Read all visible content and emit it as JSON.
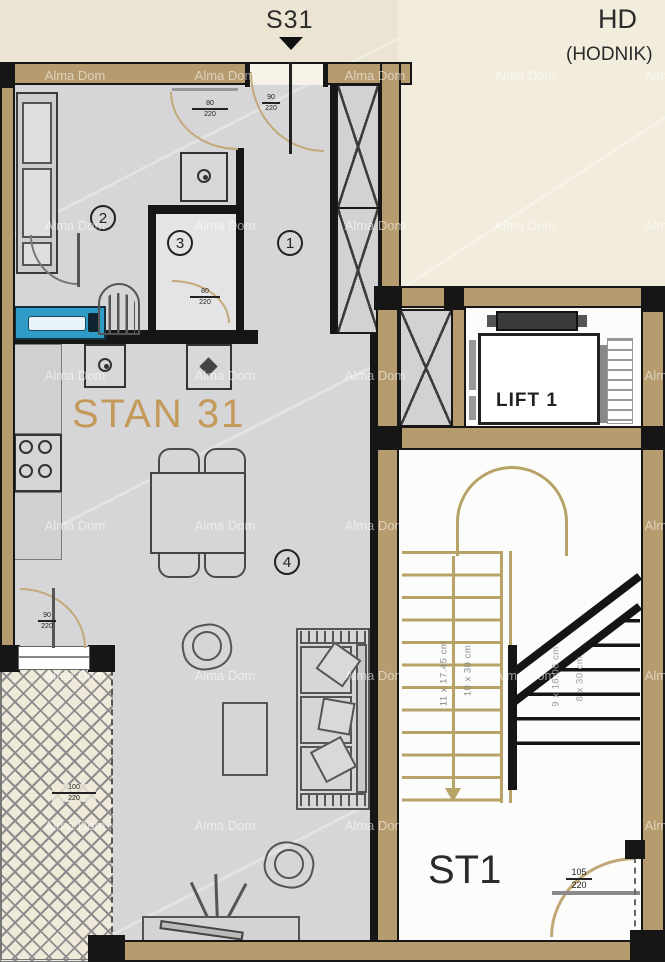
{
  "header": {
    "unit_marker": "S31",
    "zone_code": "HD",
    "zone_name": "(HODNIK)"
  },
  "apartment": {
    "name": "STAN 31",
    "room_numbers": [
      "1",
      "2",
      "3",
      "4"
    ]
  },
  "lift": {
    "label": "LIFT 1"
  },
  "stairwell": {
    "label": "ST1",
    "left_flight": {
      "riser_note": "11 x 17.45 cm",
      "tread_note": "10 x 30 cm"
    },
    "right_flight": {
      "riser_note": "9 x 18.06 cm",
      "tread_note": "8 x 30 cm"
    }
  },
  "dimensions": {
    "entrance_door": {
      "w": "90",
      "h": "220"
    },
    "room_door_top": {
      "w": "80",
      "h": "220"
    },
    "room_door_bottom": {
      "w": "80",
      "h": "220"
    },
    "balcony_door": {
      "w": "90",
      "h": "220"
    },
    "balcony_window": {
      "w": "100",
      "h": "220"
    },
    "stair_door": {
      "w": "105",
      "h": "220"
    }
  },
  "watermark": {
    "text": "Alma Dom"
  },
  "colors": {
    "wall_wood": "#b59b6d",
    "stair_tread": "#b7a267",
    "label_gold": "#c49a5a",
    "fixture_blue": "#2f9cc7",
    "floor_gray": "#d6d6d8",
    "paper_cream": "#ebe4d3"
  }
}
